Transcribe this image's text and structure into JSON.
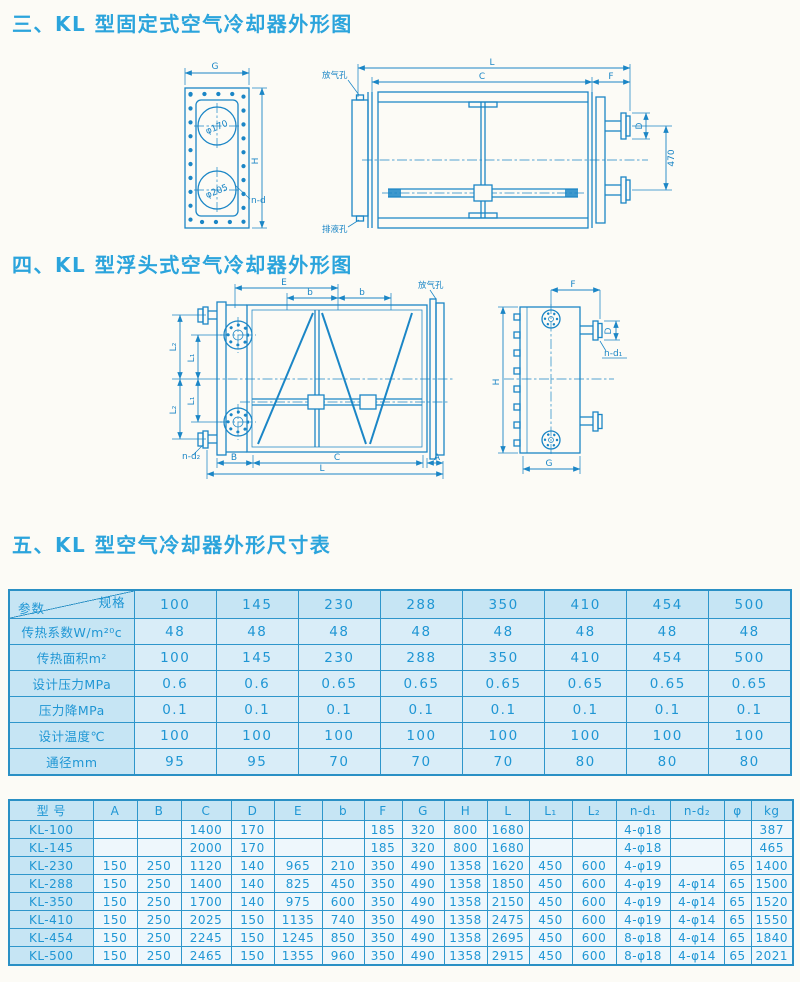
{
  "page": {
    "section3_title": "三、KL 型固定式空气冷却器外形图",
    "section4_title": "四、KL 型浮头式空气冷却器外形图",
    "section5_title": "五、KL 型空气冷却器外形尺寸表"
  },
  "colors": {
    "line_blue": "#1b86c6",
    "title_blue": "#2ba4dc",
    "table_border": "#2e96cb",
    "table_text": "#1f96d4",
    "header_bg": "#c6e5f4",
    "cell_bg": "#d9edf8",
    "page_bg": "#fcfbf6"
  },
  "drawing_fixed": {
    "labels": {
      "g": "G",
      "h": "H",
      "nd": "n-d",
      "dia_top": "φ170",
      "dia_bottom": "φ205",
      "l": "L",
      "c": "C",
      "f": "F",
      "d": "D",
      "v470": "470",
      "vent": "放气孔",
      "drain": "排液孔"
    }
  },
  "drawing_floating": {
    "labels": {
      "e": "E",
      "b": "b",
      "l1": "L₁",
      "l2": "L₂",
      "bdim": "B",
      "c": "C",
      "l": "L",
      "a": "A",
      "nd2": "n-d₂",
      "nd1": "n-d₁",
      "vent": "放气孔",
      "f": "F",
      "d": "D",
      "h": "H",
      "g": "G"
    }
  },
  "table1": {
    "corner_top": "规格",
    "corner_bottom": "参数",
    "columns": [
      "100",
      "145",
      "230",
      "288",
      "350",
      "410",
      "454",
      "500"
    ],
    "rows": [
      {
        "label": "传热系数W/m²⁰c",
        "values": [
          "48",
          "48",
          "48",
          "48",
          "48",
          "48",
          "48",
          "48"
        ]
      },
      {
        "label": "传热面积m²",
        "values": [
          "100",
          "145",
          "230",
          "288",
          "350",
          "410",
          "454",
          "500"
        ]
      },
      {
        "label": "设计压力MPa",
        "values": [
          "0.6",
          "0.6",
          "0.65",
          "0.65",
          "0.65",
          "0.65",
          "0.65",
          "0.65"
        ]
      },
      {
        "label": "压力降MPa",
        "values": [
          "0.1",
          "0.1",
          "0.1",
          "0.1",
          "0.1",
          "0.1",
          "0.1",
          "0.1"
        ]
      },
      {
        "label": "设计温度℃",
        "values": [
          "100",
          "100",
          "100",
          "100",
          "100",
          "100",
          "100",
          "100"
        ]
      },
      {
        "label": "通径mm",
        "values": [
          "95",
          "95",
          "70",
          "70",
          "70",
          "80",
          "80",
          "80"
        ]
      }
    ]
  },
  "table2": {
    "headers": [
      "型 号",
      "A",
      "B",
      "C",
      "D",
      "E",
      "b",
      "F",
      "G",
      "H",
      "L",
      "L₁",
      "L₂",
      "n-d₁",
      "n-d₂",
      "φ",
      "kg"
    ],
    "rows": [
      [
        "KL-100",
        "",
        "",
        "1400",
        "170",
        "",
        "",
        "185",
        "320",
        "800",
        "1680",
        "",
        "",
        "4-φ18",
        "",
        "",
        "387"
      ],
      [
        "KL-145",
        "",
        "",
        "2000",
        "170",
        "",
        "",
        "185",
        "320",
        "800",
        "1680",
        "",
        "",
        "4-φ18",
        "",
        "",
        "465"
      ],
      [
        "KL-230",
        "150",
        "250",
        "1120",
        "140",
        "965",
        "210",
        "350",
        "490",
        "1358",
        "1620",
        "450",
        "600",
        "4-φ19",
        "",
        "65",
        "1400"
      ],
      [
        "KL-288",
        "150",
        "250",
        "1400",
        "140",
        "825",
        "450",
        "350",
        "490",
        "1358",
        "1850",
        "450",
        "600",
        "4-φ19",
        "4-φ14",
        "65",
        "1500"
      ],
      [
        "KL-350",
        "150",
        "250",
        "1700",
        "140",
        "975",
        "600",
        "350",
        "490",
        "1358",
        "2150",
        "450",
        "600",
        "4-φ19",
        "4-φ14",
        "65",
        "1520"
      ],
      [
        "KL-410",
        "150",
        "250",
        "2025",
        "150",
        "1135",
        "740",
        "350",
        "490",
        "1358",
        "2475",
        "450",
        "600",
        "4-φ19",
        "4-φ14",
        "65",
        "1550"
      ],
      [
        "KL-454",
        "150",
        "250",
        "2245",
        "150",
        "1245",
        "850",
        "350",
        "490",
        "1358",
        "2695",
        "450",
        "600",
        "8-φ18",
        "4-φ14",
        "65",
        "1840"
      ],
      [
        "KL-500",
        "150",
        "250",
        "2465",
        "150",
        "1355",
        "960",
        "350",
        "490",
        "1358",
        "2915",
        "450",
        "600",
        "8-φ18",
        "4-φ14",
        "65",
        "2021"
      ]
    ]
  }
}
